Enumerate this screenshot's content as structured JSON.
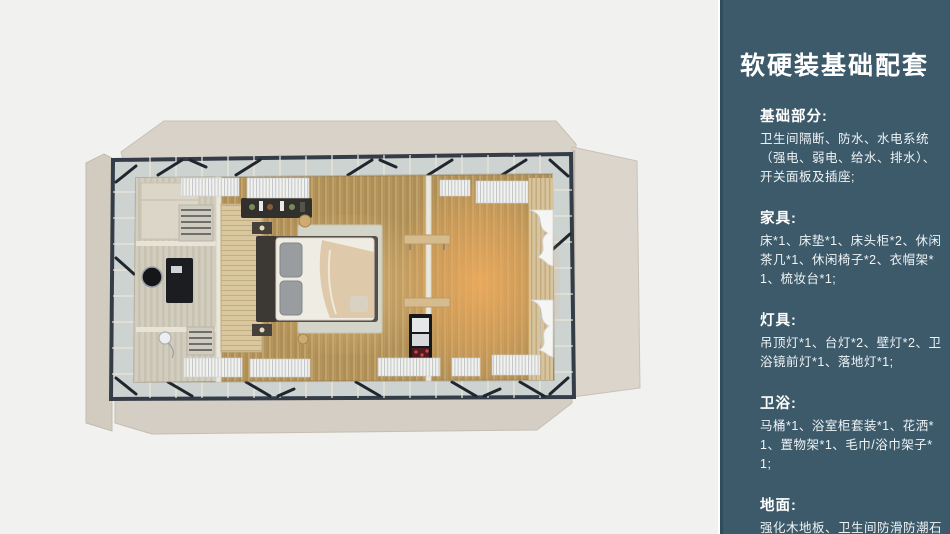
{
  "colors": {
    "canvas_bg": "#f1f1f0",
    "panel_bg": "#3d5a6b",
    "panel_text": "#ffffff",
    "building_flap": "#d8d1c7",
    "steel_frame": "#343d47",
    "wood_floor": "#c1a268",
    "warm_light": "#f2ae5e"
  },
  "panel": {
    "title": "软硬装基础配套",
    "sections": [
      {
        "heading": "基础部分:",
        "body": "卫生间隔断、防水、水电系统（强电、弱电、给水、排水）、开关面板及插座;"
      },
      {
        "heading": "家具:",
        "body": "床*1、床垫*1、床头柜*2、休闲茶几*1、休闲椅子*2、衣帽架*1、梳妆台*1;"
      },
      {
        "heading": "灯具:",
        "body": "吊顶灯*1、台灯*2、壁灯*2、卫浴镜前灯*1、落地灯*1;"
      },
      {
        "heading": "卫浴:",
        "body": "马桶*1、浴室柜套装*1、花洒*1、置物架*1、毛巾/浴巾架子*1;"
      },
      {
        "heading": "地面:",
        "body": "强化木地板、卫生间防滑防潮石塑板;"
      }
    ]
  }
}
